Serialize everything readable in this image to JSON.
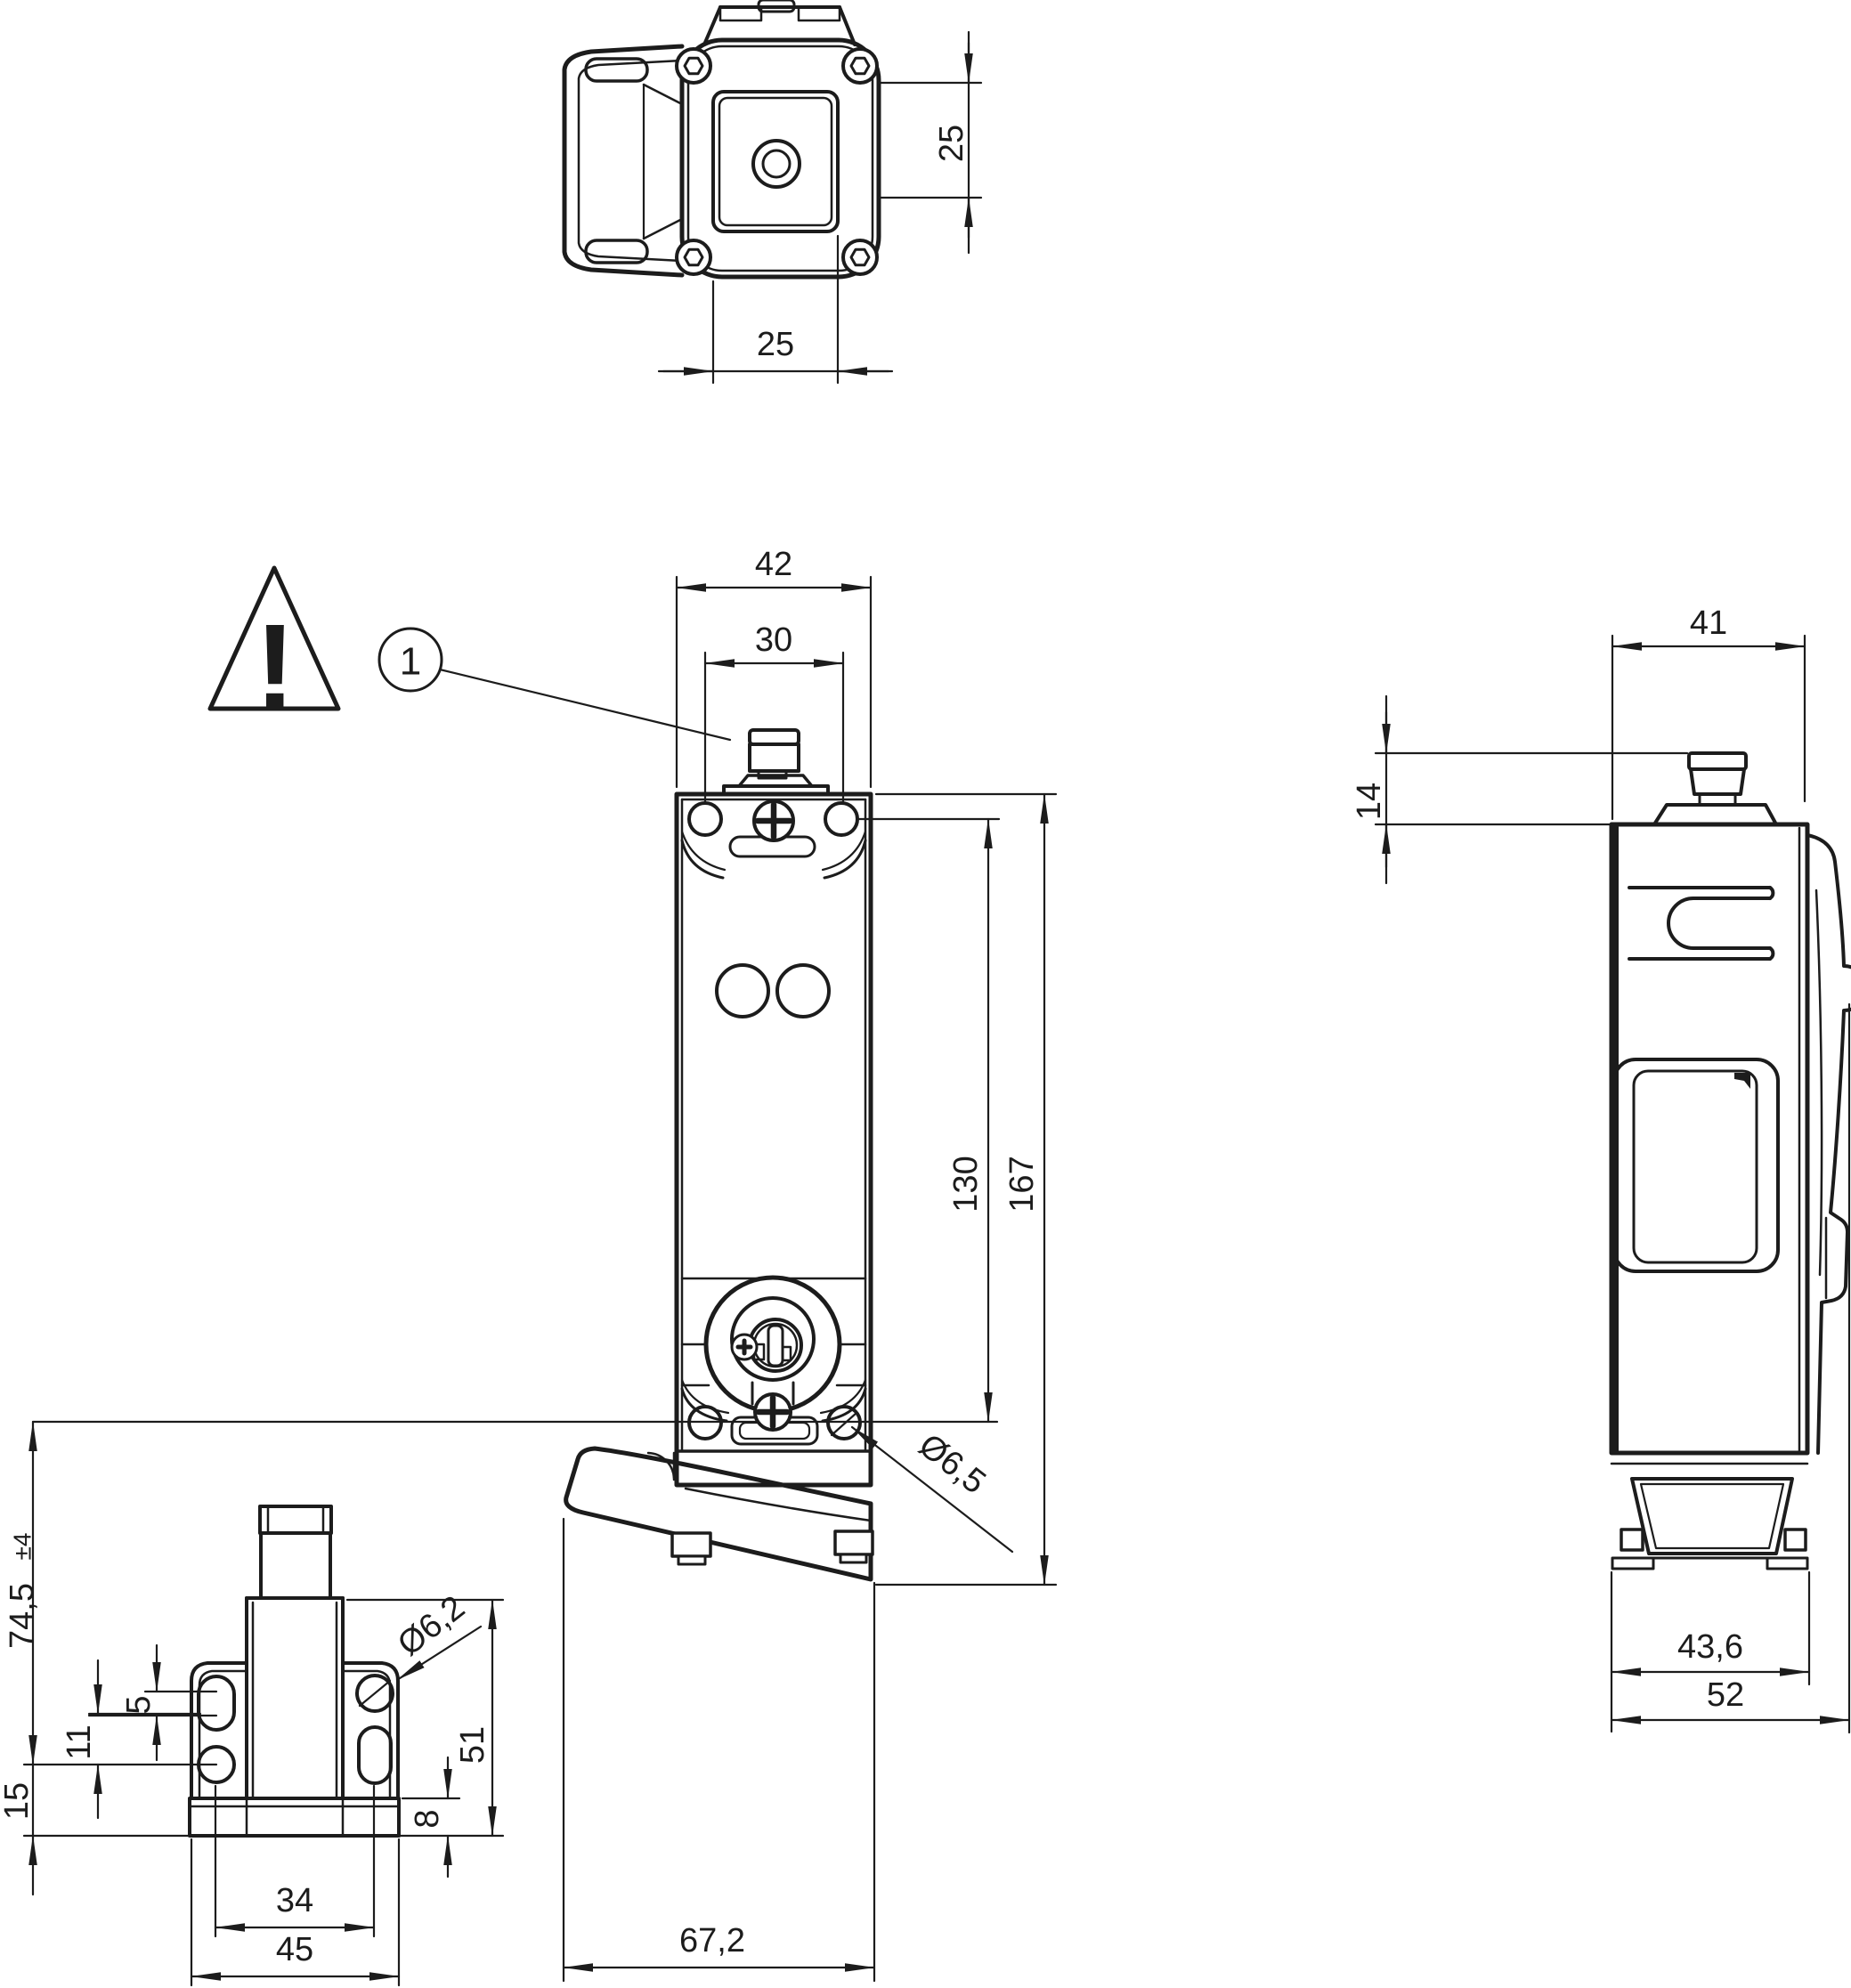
{
  "drawing": {
    "description": "Technical dimension drawing of a safety interlock switch with separate actuator, four views",
    "units": "mm",
    "colors": {
      "line": "#1c1c1c",
      "background": "#ffffff"
    },
    "callouts": {
      "warning_symbol": "!",
      "item_number": "1"
    },
    "views": {
      "top": {
        "dims": {
          "head_width": "25",
          "head_height": "25"
        }
      },
      "front": {
        "dims": {
          "body_width": "42",
          "hole_spacing": "30",
          "mounting_hole_distance": "130",
          "total_height": "167",
          "mounting_hole_diameter": "Ø6,5",
          "overall_width_with_guide": "67,2"
        }
      },
      "side": {
        "dims": {
          "body_depth": "41",
          "connector_height": "14",
          "foot_depth": "43,6",
          "overall_depth": "52"
        }
      },
      "actuator": {
        "dims": {
          "engagement_depth": "74,5",
          "engagement_tolerance": "±4",
          "slot_length": "5",
          "hole_offset": "11",
          "base_offset": "15",
          "flange_height": "51",
          "base_thickness": "8",
          "hole_spacing": "34",
          "base_width": "45",
          "hole_diameter": "Ø6,2"
        }
      }
    }
  }
}
